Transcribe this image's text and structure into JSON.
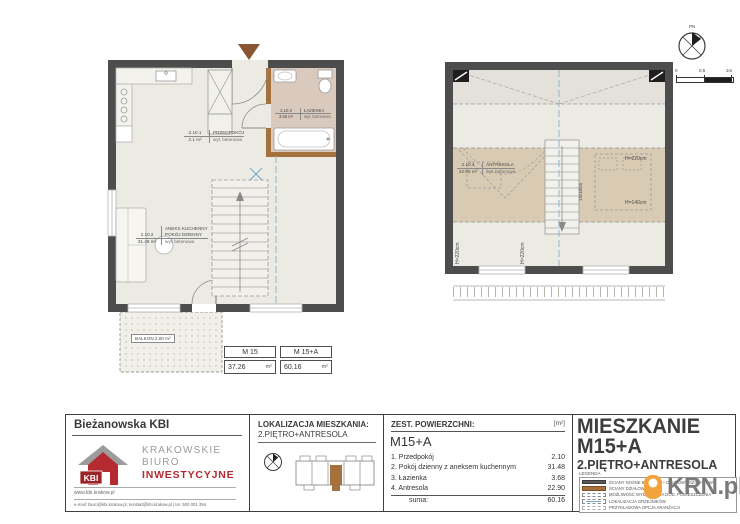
{
  "colors": {
    "wall": "#4d4d4d",
    "partition": "#a5713c",
    "floor": "#ecebe3",
    "bath_floor": "#dac9bd",
    "mezzanine_low_zone": "#d9cab3",
    "upper_void_zone": "#e3e1d9",
    "section_blue": "#8fb6cf",
    "brand_red": "#b32a31",
    "krn_orange": "#f2a33c"
  },
  "plan_lower": {
    "rooms": {
      "hall": {
        "id": "2.10.1",
        "area": "2.1 m²",
        "name": "PRZEDPOKÓJ",
        "floor": "wył. betonowa"
      },
      "living": {
        "id": "2.10.2",
        "area": "31.48 m²",
        "name": "ANEKS KUCHENNY\nPOKÓJ DZIENNY",
        "floor": "wył. betonowa"
      },
      "bath": {
        "id": "2.10.3",
        "area": "3.68 m²",
        "name": "ŁAZIENKA",
        "floor": "wył. betonowa"
      }
    },
    "balcony_label": "BALKON 2.00 m²"
  },
  "plan_upper": {
    "room": {
      "id": "2.10.4",
      "area": "22.90 m²",
      "name": "ANTRESOLA",
      "floor": "wył. betonowa"
    },
    "heights": {
      "right_top": "H=220cm",
      "right_bottom": "H=140cm",
      "left_a": "H=220cm",
      "left_b": "H=220cm"
    },
    "stairs_note": "19x18/25"
  },
  "compass": {
    "north_label": "PN"
  },
  "scalebar": {
    "t0": "0",
    "t1": "0,5",
    "t2": "1m"
  },
  "summary_table": {
    "col1": {
      "header": "M 15",
      "value": "37.26",
      "unit": "m²"
    },
    "col2": {
      "header": "M 15+A",
      "value": "60.16",
      "unit": "m²"
    }
  },
  "titleblock": {
    "company": {
      "project": "Bieżanowska KBI",
      "logo_abbr": "KBI",
      "name1": "KRAKOWSKIE",
      "name2": "BIURO",
      "name3": "INWESTYCYJNE",
      "website": "www.kbi.krakow.pl",
      "contact": "e-mail: biuro@kbi.krakow.pl, kontakt@kbi.krakow.pl | tel. 500 001 394"
    },
    "location": {
      "label": "LOKALIZACJA MIESZKANIA:",
      "value": "2.PIĘTRO+ANTRESOLA"
    },
    "areas": {
      "header": "ZEST. POWIERZCHNI:",
      "unit": "[m²]",
      "unit_code": "M15+A",
      "rows": [
        {
          "name": "1. Przedpokój",
          "value": "2.10"
        },
        {
          "name": "2. Pokój dzienny z aneksem kuchennym",
          "value": "31.48"
        },
        {
          "name": "3. Łazienka",
          "value": "3.68"
        },
        {
          "name": "4. Antresola",
          "value": "22.90"
        }
      ],
      "sum_label": "suma:",
      "sum_value": "60.16"
    },
    "apartment": {
      "line1": "MIESZKANIE",
      "line2": "M15+A",
      "line3": "2.PIĘTRO+ANTRESOLA"
    },
    "legend": {
      "header": "LEGENDA",
      "items": [
        {
          "label": "ŚCIANY NOŚNE BUDYNKU I OBUDOWY SZACHTÓW"
        },
        {
          "label": "ŚCIANY DZIAŁOWE"
        },
        {
          "label": "MOŻLIWOŚĆ WYDZIELENIA DOD. POMIESZCZENIA"
        },
        {
          "label": "LOKALIZACJA GRZEJNIKÓW"
        },
        {
          "label": "PRZYKŁADOWA OPCJA ARANŻACJI"
        }
      ]
    },
    "krn_logo_text": "KRN.pl"
  }
}
